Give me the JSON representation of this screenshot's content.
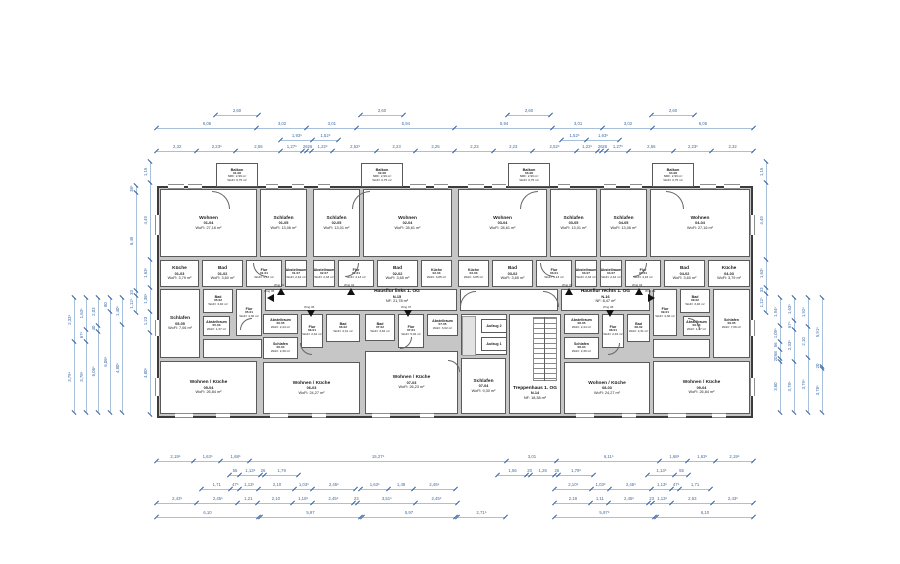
{
  "plan": {
    "colors": {
      "wall_fill": "#c6c6c6",
      "wall_edge": "#5a5a5a",
      "dimension_text": "#3f6ea8",
      "dimension_line": "#a9c0da",
      "background": "#ffffff",
      "room_text": "#1c1c1c"
    },
    "rooms": [
      {
        "n": "Wohnen",
        "i": "01-04",
        "a": "WoFl: 27,16 m²",
        "b": [
          160,
          189,
          97,
          68
        ]
      },
      {
        "n": "Schlafen",
        "i": "01-05",
        "a": "WoFl: 13,06 m²",
        "b": [
          260,
          189,
          47,
          68
        ]
      },
      {
        "n": "Küche",
        "i": "01-03",
        "a": "WoFl: 3,79 m²",
        "b": [
          160,
          260,
          39,
          27
        ]
      },
      {
        "n": "Bad",
        "i": "01-02",
        "a": "WoFl: 3,60 m²",
        "b": [
          202,
          260,
          41,
          27
        ]
      },
      {
        "n": "Flur",
        "i": "01-01",
        "a": "WoFl: 4,16 m²",
        "b": [
          246,
          260,
          36,
          27
        ]
      },
      {
        "n": "Abstellraum",
        "i": "01-07",
        "a": "WoFl: 2,42 m²",
        "b": [
          285,
          260,
          22,
          27
        ]
      },
      {
        "n": "Schlafen",
        "i": "02-05",
        "a": "WoFl: 13,01 m²",
        "b": [
          313,
          189,
          47,
          68
        ]
      },
      {
        "n": "Wohnen",
        "i": "02-04",
        "a": "WoFl: 28,61 m²",
        "b": [
          363,
          189,
          89,
          68
        ]
      },
      {
        "n": "Abstellraum",
        "i": "02-07",
        "a": "WoFl: 2,33 m²",
        "b": [
          313,
          260,
          22,
          27
        ]
      },
      {
        "n": "Flur",
        "i": "02-01",
        "a": "WoFl: 4,13 m²",
        "b": [
          338,
          260,
          36,
          27
        ]
      },
      {
        "n": "Bad",
        "i": "02-02",
        "a": "WoFl: 3,65 m²",
        "b": [
          377,
          260,
          41,
          27
        ]
      },
      {
        "n": "Küche",
        "i": "02-03",
        "a": "WoFl: 3,85 m²",
        "b": [
          421,
          260,
          31,
          27
        ]
      },
      {
        "n": "Wohnen",
        "i": "03-04",
        "a": "WoFl: 28,61 m²",
        "b": [
          458,
          189,
          89,
          68
        ]
      },
      {
        "n": "Schlafen",
        "i": "03-05",
        "a": "WoFl: 13,01 m²",
        "b": [
          550,
          189,
          47,
          68
        ]
      },
      {
        "n": "Küche",
        "i": "03-03",
        "a": "WoFl: 3,85 m²",
        "b": [
          458,
          260,
          31,
          27
        ]
      },
      {
        "n": "Bad",
        "i": "03-02",
        "a": "WoFl: 3,65 m²",
        "b": [
          492,
          260,
          41,
          27
        ]
      },
      {
        "n": "Flur",
        "i": "03-01",
        "a": "WoFl: 4,13 m²",
        "b": [
          536,
          260,
          36,
          27
        ]
      },
      {
        "n": "Abstellraum",
        "i": "03-07",
        "a": "WoFl: 2,33 m²",
        "b": [
          575,
          260,
          22,
          27
        ]
      },
      {
        "n": "Schlafen",
        "i": "04-05",
        "a": "WoFl: 13,06 m²",
        "b": [
          600,
          189,
          47,
          68
        ]
      },
      {
        "n": "Wohnen",
        "i": "04-04",
        "a": "WoFl: 27,16 m²",
        "b": [
          650,
          189,
          100,
          68
        ]
      },
      {
        "n": "Abstellraum",
        "i": "04-07",
        "a": "WoFl: 2,42 m²",
        "b": [
          600,
          260,
          22,
          27
        ]
      },
      {
        "n": "Flur",
        "i": "04-01",
        "a": "WoFl: 4,16 m²",
        "b": [
          625,
          260,
          36,
          27
        ]
      },
      {
        "n": "Bad",
        "i": "04-02",
        "a": "WoFl: 3,60 m²",
        "b": [
          664,
          260,
          41,
          27
        ]
      },
      {
        "n": "Küche",
        "i": "04-03",
        "a": "WoFl: 3,79 m²",
        "b": [
          708,
          260,
          42,
          27
        ]
      },
      {
        "n": "Schlafen",
        "i": "05-05",
        "a": "WoFl: 7,06 m²",
        "b": [
          160,
          289,
          40,
          69
        ]
      },
      {
        "n": "Bad",
        "i": "05-02",
        "a": "WoFl: 3,40 m²",
        "b": [
          203,
          289,
          30,
          24
        ]
      },
      {
        "n": "Flur",
        "i": "05-01",
        "a": "WoFl: 4,30 m²",
        "b": [
          236,
          289,
          26,
          47
        ]
      },
      {
        "n": "Abstellraum",
        "i": "05-03",
        "a": "WoFl: 1,37 m²",
        "b": [
          203,
          316,
          27,
          20
        ]
      },
      {
        "n": "Wohnen / Küche",
        "i": "05-04",
        "a": "WoFl: 26,84 m²",
        "b": [
          160,
          361,
          97,
          53
        ]
      },
      {
        "n": "Abstellraum",
        "i": "06-05",
        "a": "WoFl: 2,44 m²",
        "b": [
          263,
          314,
          35,
          20
        ]
      },
      {
        "n": "Flur",
        "i": "06-01",
        "a": "WoFl: 2,42 m²",
        "b": [
          301,
          314,
          22,
          34
        ]
      },
      {
        "n": "Bad",
        "i": "06-02",
        "a": "WoFl: 4,31 m²",
        "b": [
          326,
          314,
          34,
          28
        ]
      },
      {
        "n": "Schlafen",
        "i": "06-04",
        "a": "WoFl: 2,30 m²",
        "b": [
          263,
          337,
          35,
          22
        ]
      },
      {
        "n": "Wohnen / Küche",
        "i": "06-03",
        "a": "WoFl: 24,27 m²",
        "b": [
          263,
          362,
          97,
          52
        ]
      },
      {
        "n": "Bad",
        "i": "07-02",
        "a": "WoFl: 3,62 m²",
        "b": [
          365,
          314,
          30,
          27
        ]
      },
      {
        "n": "Flur",
        "i": "07-01",
        "a": "WoFl: 5,02 m²",
        "b": [
          398,
          314,
          26,
          34
        ]
      },
      {
        "n": "Abstellraum",
        "i": "07-05",
        "a": "WoFl: 3,02 m²",
        "b": [
          427,
          314,
          31,
          22
        ]
      },
      {
        "n": "Wohnen / Küche",
        "i": "07-03",
        "a": "WoFl: 26,23 m²",
        "b": [
          365,
          351,
          93,
          63
        ]
      },
      {
        "n": "Schlafen",
        "i": "07-04",
        "a": "WoFl: 9,30 m²",
        "b": [
          461,
          358,
          45,
          56
        ]
      },
      {
        "n": "Abstellraum",
        "i": "08-05",
        "a": "WoFl: 2,44 m²",
        "b": [
          564,
          314,
          35,
          20
        ]
      },
      {
        "n": "Flur",
        "i": "08-01",
        "a": "WoFl: 2,42 m²",
        "b": [
          602,
          314,
          22,
          34
        ]
      },
      {
        "n": "Bad",
        "i": "08-02",
        "a": "WoFl: 4,31 m²",
        "b": [
          627,
          314,
          23,
          28
        ]
      },
      {
        "n": "Schlafen",
        "i": "08-04",
        "a": "WoFl: 2,30 m²",
        "b": [
          564,
          337,
          35,
          22
        ]
      },
      {
        "n": "Wohnen / Küche",
        "i": "08-03",
        "a": "WoFl: 24,27 m²",
        "b": [
          564,
          362,
          86,
          52
        ]
      },
      {
        "n": "Flur",
        "i": "09-01",
        "a": "WoFl: 4,30 m²",
        "b": [
          653,
          289,
          24,
          47
        ]
      },
      {
        "n": "Bad",
        "i": "09-02",
        "a": "WoFl: 3,40 m²",
        "b": [
          680,
          289,
          30,
          24
        ]
      },
      {
        "n": "Abstellraum",
        "i": "09-03",
        "a": "WoFl: 1,37 m²",
        "b": [
          683,
          316,
          27,
          20
        ]
      },
      {
        "n": "Schlafen",
        "i": "09-05",
        "a": "WoFl: 7,06 m²",
        "b": [
          713,
          289,
          37,
          69
        ]
      },
      {
        "n": "Wohnen / Küche",
        "i": "09-04",
        "a": "WoFl: 26,84 m²",
        "b": [
          653,
          361,
          97,
          53
        ]
      }
    ],
    "balconies": [
      {
        "id": "01-08",
        "lines": [
          "Balkon",
          "01-08",
          "NRF: 2,99 m²",
          "WoFl: 0,75 m²"
        ],
        "b": [
          216,
          163,
          42,
          24
        ]
      },
      {
        "id": "02-08",
        "lines": [
          "Balkon",
          "02-08",
          "NRF: 2,99 m²",
          "WoFl: 0,75 m²"
        ],
        "b": [
          361,
          163,
          42,
          24
        ]
      },
      {
        "id": "03-08",
        "lines": [
          "Balkon",
          "03-08",
          "NRF: 2,99 m²",
          "WoFl: 0,75 m²"
        ],
        "b": [
          508,
          163,
          42,
          24
        ]
      },
      {
        "id": "04-08",
        "lines": [
          "Balkon",
          "04-08",
          "NRF: 2,99 m²",
          "WoFl: 0,75 m²"
        ],
        "b": [
          652,
          163,
          42,
          24
        ]
      }
    ],
    "commons": {
      "hausflur_links": {
        "lines": [
          "Hausflur links 1. OG",
          "N-15",
          "NF: 21,78 m²"
        ],
        "box": [
          265,
          289,
          192,
          22
        ],
        "label": [
          357,
          289,
          80,
          15
        ]
      },
      "hausflur_rechts": {
        "lines": [
          "Hausflur rechts 1. OG",
          "N-16",
          "NF: 8,47 m²"
        ],
        "box": [
          561,
          289,
          89,
          22
        ],
        "label": [
          564,
          289,
          83,
          15
        ]
      },
      "treppenhaus": {
        "lines": [
          "Treppenhaus 1. OG",
          "N-14",
          "NF: 18,38 m²"
        ],
        "box": [
          509,
          314,
          52,
          100
        ],
        "label": [
          497,
          385,
          76,
          16
        ]
      },
      "aufzug1": {
        "label": "Aufzug 1",
        "box": [
          481,
          337,
          26,
          14
        ]
      },
      "aufzug2": {
        "label": "Aufzug 2",
        "box": [
          481,
          319,
          26,
          14
        ]
      }
    },
    "wng": [
      {
        "l": "Wng 01",
        "x": 277,
        "y": 288,
        "d": "up"
      },
      {
        "l": "Wng 02",
        "x": 347,
        "y": 288,
        "d": "up"
      },
      {
        "l": "Wng 03",
        "x": 565,
        "y": 288,
        "d": "up"
      },
      {
        "l": "Wng 04",
        "x": 635,
        "y": 288,
        "d": "up"
      },
      {
        "l": "Wng 05",
        "x": 267,
        "y": 294,
        "d": "left"
      },
      {
        "l": "Wng 06",
        "x": 307,
        "y": 310,
        "d": "down"
      },
      {
        "l": "Wng 07",
        "x": 404,
        "y": 310,
        "d": "down"
      },
      {
        "l": "Wng 08",
        "x": 606,
        "y": 310,
        "d": "down"
      },
      {
        "l": "Wng 09",
        "x": 648,
        "y": 294,
        "d": "right"
      }
    ],
    "dims": {
      "top": [
        {
          "b": [
            216,
            107,
            42
          ],
          "s": [
            "2,60"
          ]
        },
        {
          "b": [
            361,
            107,
            42
          ],
          "s": [
            "2,60"
          ]
        },
        {
          "b": [
            508,
            107,
            42
          ],
          "s": [
            "2,60"
          ]
        },
        {
          "b": [
            652,
            107,
            42
          ],
          "s": [
            "2,60"
          ]
        },
        {
          "b": [
            157,
            120,
            596
          ],
          "s": [
            "6,05",
            "3,02",
            "3,01",
            "5,94",
            "5,94",
            "3,01",
            "3,02",
            "6,05"
          ]
        },
        {
          "b": [
            281,
            132,
            57
          ],
          "s": [
            "1,93⁵",
            "1,52⁵"
          ]
        },
        {
          "b": [
            562,
            132,
            57
          ],
          "s": [
            "1,52⁵",
            "1,93⁵"
          ]
        },
        {
          "b": [
            157,
            143,
            596
          ],
          "s": [
            "2,32",
            "2,23⁵",
            "2,56",
            "1,27⁵",
            "26",
            "26",
            "1,22⁵",
            "2,52⁵",
            "2,23",
            "2,25",
            "2,23",
            "2,23",
            "2,52⁵",
            "1,22⁵",
            "26",
            "26",
            "1,27⁵",
            "2,56",
            "2,23⁵",
            "2,32"
          ]
        }
      ],
      "bottom": [
        {
          "b": [
            157,
            453,
            596
          ],
          "s": [
            "2,19⁵",
            "1,63⁵",
            "1,68⁵",
            "15,27⁵",
            "3,01",
            "6,11⁵",
            "1,68⁵",
            "1,63⁵",
            "2,19⁵"
          ]
        },
        {
          "b": [
            230,
            467,
            68
          ],
          "s": [
            "55",
            "1,13⁵",
            "26",
            "1,79"
          ]
        },
        {
          "b": [
            498,
            467,
            95
          ],
          "s": [
            "1,56",
            "20",
            "1,26",
            "26",
            "1,79⁵"
          ]
        },
        {
          "b": [
            648,
            467,
            40
          ],
          "s": [
            "1,13⁵",
            "55"
          ]
        },
        {
          "b": [
            202,
            481,
            153
          ],
          "s": [
            "1,71",
            "47⁵",
            "1,13⁵",
            "2,10",
            "1,03⁵",
            "2,45⁵"
          ]
        },
        {
          "b": [
            361,
            481,
            94
          ],
          "s": [
            "1,63⁵",
            "1,49",
            "2,45⁵"
          ]
        },
        {
          "b": [
            555,
            481,
            155
          ],
          "s": [
            "2,10⁵",
            "1,03⁵",
            "2,45⁵",
            "1,13⁵",
            "47⁵",
            "1,71"
          ]
        },
        {
          "b": [
            157,
            495,
            300
          ],
          "s": [
            "2,43⁵",
            "2,45⁵",
            "1,21",
            "2,10",
            "1,18⁵",
            "2,45⁵",
            "23",
            "3,51⁵",
            "2,45⁵"
          ]
        },
        {
          "b": [
            555,
            495,
            198
          ],
          "s": [
            "2,18",
            "1,11",
            "2,45⁵",
            "23",
            "1,13⁵",
            "2,53",
            "2,43⁵"
          ]
        },
        {
          "b": [
            157,
            509,
            101
          ],
          "s": [
            "6,10"
          ]
        },
        {
          "b": [
            261,
            509,
            99
          ],
          "s": [
            "5,97"
          ]
        },
        {
          "b": [
            363,
            509,
            92
          ],
          "s": [
            "5,97"
          ]
        },
        {
          "b": [
            458,
            509,
            47
          ],
          "s": [
            "2,71⁵"
          ]
        },
        {
          "b": [
            555,
            509,
            99
          ],
          "s": [
            "5,97⁵"
          ]
        },
        {
          "b": [
            657,
            509,
            96
          ],
          "s": [
            "6,10"
          ]
        }
      ],
      "left": [
        {
          "b": [
            142,
            162,
            252
          ],
          "s": [
            "4,80⁵",
            "1,23",
            "1,38⁵",
            "1,63⁵",
            "4,49",
            "1,15"
          ]
        },
        {
          "b": [
            128,
            186,
            126
          ],
          "s": [
            "1,12⁵",
            "33",
            "6,49",
            "38⁵"
          ]
        },
        {
          "b": [
            66,
            298,
            114
          ],
          "s": [
            "3,79⁵",
            "2,33⁵"
          ]
        },
        {
          "b": [
            78,
            298,
            114
          ],
          "s": [
            "3,78⁵",
            "67⁵",
            "1,63⁵"
          ]
        },
        {
          "b": [
            90,
            298,
            114
          ],
          "s": [
            "6,06⁵",
            "40",
            "2,03"
          ]
        },
        {
          "b": [
            102,
            298,
            114
          ],
          "s": [
            "6,06⁵",
            "80"
          ]
        },
        {
          "b": [
            114,
            298,
            114
          ],
          "s": [
            "4,80⁵",
            "1,40⁵"
          ]
        }
      ],
      "right": [
        {
          "b": [
            758,
            162,
            150
          ],
          "s": [
            "1,12⁵",
            "33",
            "1,63⁵",
            "4,49",
            "1,15"
          ]
        },
        {
          "b": [
            772,
            298,
            114
          ],
          "s": [
            "3,60",
            "20",
            "68",
            "56",
            "1,09⁵",
            "1,94⁵"
          ]
        },
        {
          "b": [
            786,
            298,
            114
          ],
          "s": [
            "3,78⁵",
            "2,33⁵",
            "67⁵",
            "1,63⁵"
          ]
        },
        {
          "b": [
            800,
            298,
            114
          ],
          "s": [
            "3,79⁵",
            "2,10",
            "1,92⁵"
          ]
        },
        {
          "b": [
            814,
            298,
            114
          ],
          "s": [
            "3,78⁵",
            "20",
            "5,91⁵"
          ]
        }
      ]
    }
  }
}
